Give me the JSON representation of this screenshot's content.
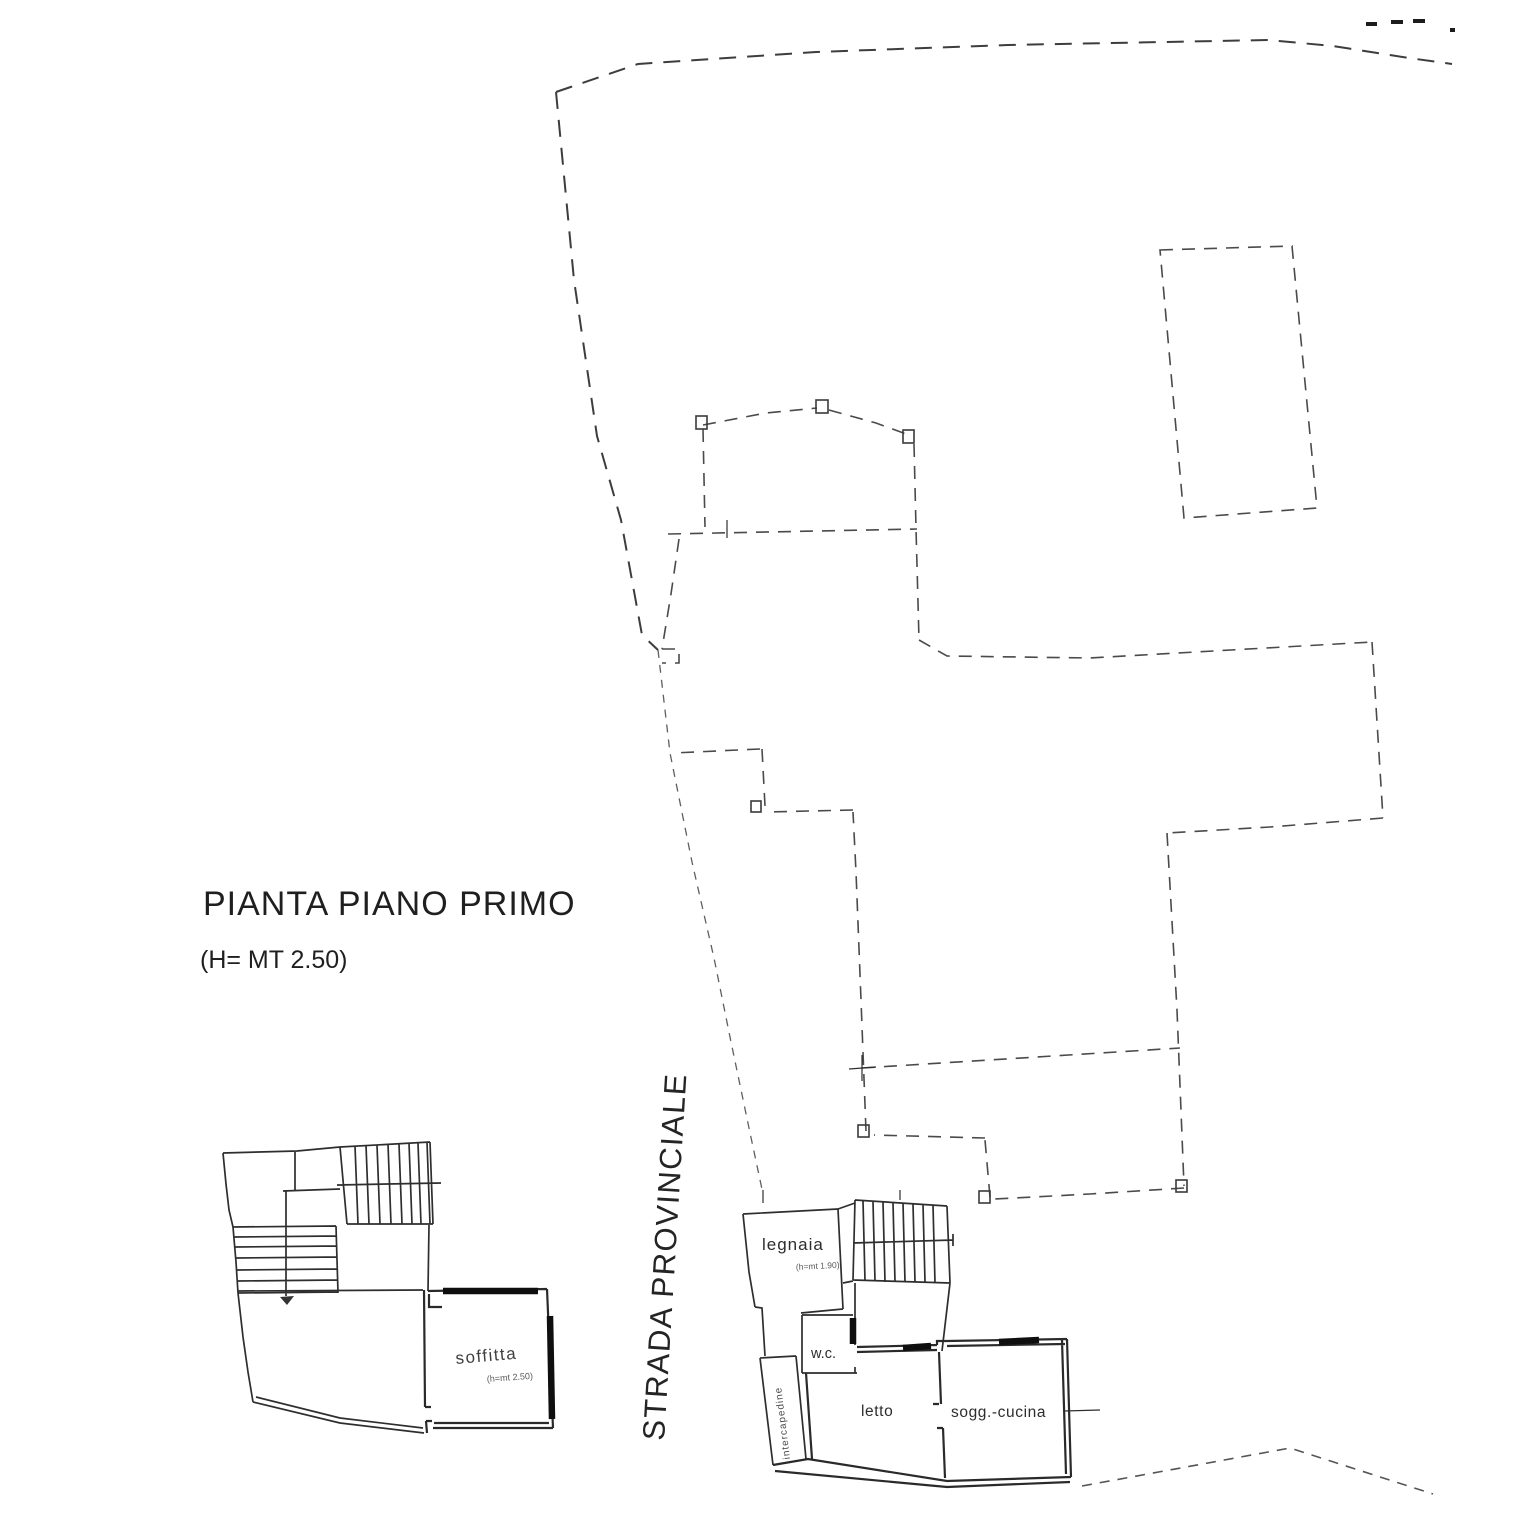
{
  "colors": {
    "background": "#ffffff",
    "ink": "#2e2e2e",
    "dashed_line": "#4a4a4a",
    "thick_wall": "#0f0f0f"
  },
  "header": {
    "title": "PIANTA PIANO PRIMO",
    "height_note": "(H= MT 2.50)"
  },
  "road": {
    "label": "STRADA PROVINCIALE"
  },
  "attic_plan": {
    "soffitta": {
      "label": "soffitta",
      "height_note": "(h=mt 2.50)"
    }
  },
  "floor_plan": {
    "legnaia": {
      "label": "legnaia",
      "height_note": "(h=mt 1.90)"
    },
    "wc": {
      "label": "w.c."
    },
    "letto": {
      "label": "letto"
    },
    "sogg_cucina": {
      "label": "sogg.-cucina"
    },
    "intercapedine": {
      "label": "intercapedine"
    }
  }
}
